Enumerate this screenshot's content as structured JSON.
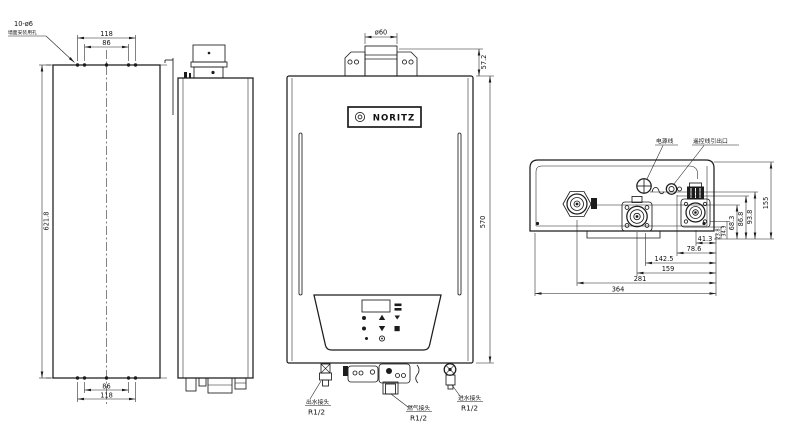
{
  "views": {
    "back": {
      "callout": "10-ø6",
      "callout_note": "墙面安装用孔",
      "dim_top_outer": "118",
      "dim_top_inner": "86",
      "dim_height": "621.8",
      "dim_bottom_inner": "86",
      "dim_bottom_outer": "118"
    },
    "front": {
      "brand": "NORITZ",
      "dim_flue_diameter": "ø60",
      "dim_flue_height": "57.2",
      "dim_body_height": "570",
      "outlet_label": "出水接头",
      "outlet_size": "R1/2",
      "gas_label": "燃气接头",
      "gas_size": "R1/2",
      "inlet_label": "进水接头",
      "inlet_size": "R1/2"
    },
    "bottom": {
      "power_label": "电源线",
      "remote_label": "遥控线引出口",
      "dim_h_683": "68.3",
      "dim_h_868": "86.8",
      "dim_h_938": "93.8",
      "dim_h_155": "155",
      "dim_w_413": "41.3",
      "dim_w_786": "78.6",
      "dim_w_1425": "142.5",
      "dim_w_159": "159",
      "dim_w_281": "281",
      "dim_w_364": "364",
      "dim_s_238": "23.8",
      "dim_s_343": "34.3"
    }
  }
}
